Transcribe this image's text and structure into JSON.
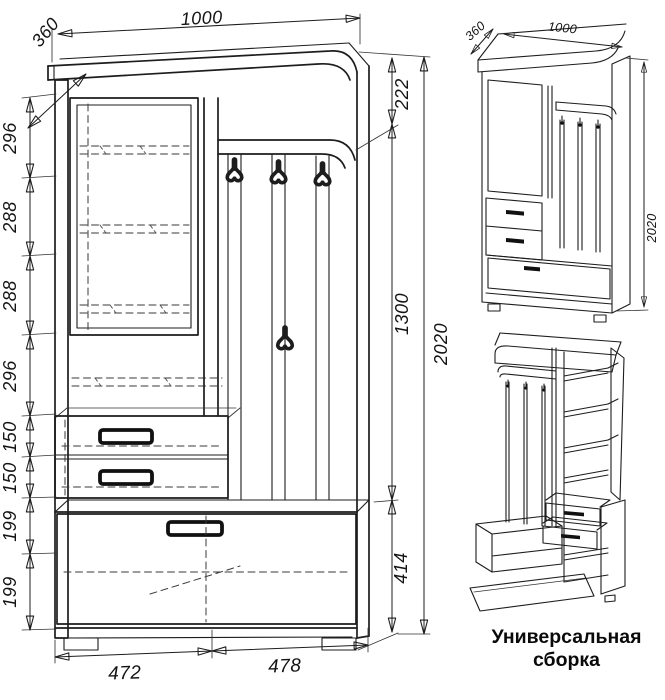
{
  "colors": {
    "line": "#1d1d1d",
    "background": "#ffffff",
    "accent_black": "#111111"
  },
  "caption": {
    "line1": "Универсальная",
    "line2": "сборка"
  },
  "front_view": {
    "top_width": "1000",
    "top_depth": "360",
    "left_chain": [
      "296",
      "288",
      "288",
      "296",
      "150",
      "150",
      "199",
      "199"
    ],
    "right_chain": {
      "hat_shelf": "222",
      "hook_panel": "1300",
      "base": "414",
      "overall": "2020"
    },
    "bottom": {
      "left_module": "472",
      "right_module": "478"
    }
  },
  "iso_view": {
    "top_depth": "360",
    "top_width": "1000",
    "overall_height": "2020"
  }
}
